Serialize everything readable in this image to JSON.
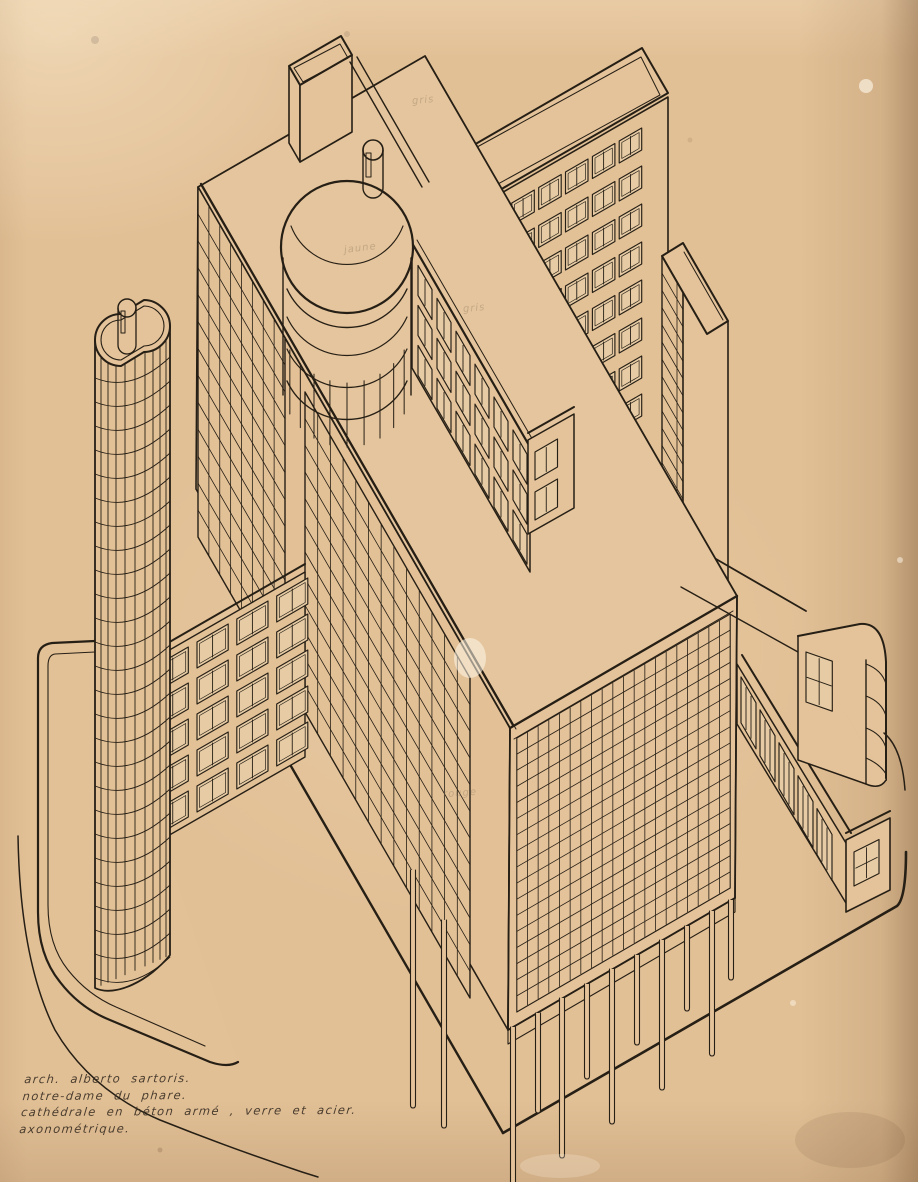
{
  "caption": {
    "lines": [
      "arch. alberto sartoris.",
      "notre-dame du phare.",
      "cathédrale en béton armé , verre et acier.",
      "axonométrique."
    ]
  },
  "annotations": [
    {
      "text": "gris"
    },
    {
      "text": "jaune"
    },
    {
      "text": "gris"
    },
    {
      "text": "rouge"
    }
  ],
  "palette": {
    "paper": "#e2c096",
    "paper_light": "#efd9b4",
    "edge_shadow": "#6b4a2c",
    "ink": "#261f15",
    "pencil": "#8b7a5f"
  }
}
